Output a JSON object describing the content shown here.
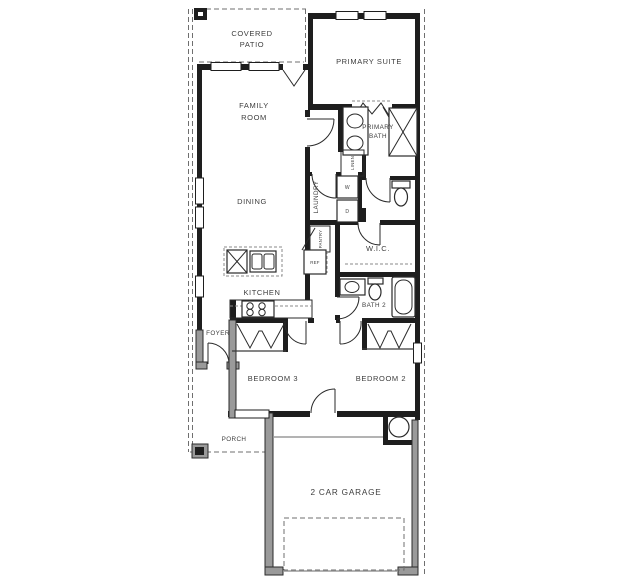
{
  "meta": {
    "type": "residential floor plan"
  },
  "colors": {
    "background": "#ffffff",
    "walls": "#1e1e1e",
    "secondary_walls": "#9a9a9a",
    "dashed_lines": "#6f6f6f",
    "label_text": "#3d3d3d"
  },
  "rooms": {
    "covered_patio": {
      "line1": "COVERED",
      "line2": "PATIO"
    },
    "primary_suite": {
      "label": "PRIMARY SUITE"
    },
    "family_room": {
      "line1": "FAMILY",
      "line2": "ROOM"
    },
    "primary_bath": {
      "line1": "PRIMARY",
      "line2": "BATH"
    },
    "dining": {
      "label": "DINING"
    },
    "laundry": {
      "label": "LAUNDRY"
    },
    "wic": {
      "label": "W.I.C."
    },
    "kitchen": {
      "label": "KITCHEN"
    },
    "bath2": {
      "label": "BATH 2"
    },
    "foyer": {
      "label": "FOYER"
    },
    "bedroom3": {
      "label": "BEDROOM 3"
    },
    "bedroom2": {
      "label": "BEDROOM 2"
    },
    "porch": {
      "label": "PORCH"
    },
    "garage": {
      "label": "2 CAR GARAGE"
    }
  },
  "fixtures": {
    "washer": "W",
    "dryer": "D",
    "refrigerator": "REF",
    "linen": "LINEN",
    "pantry": "PANTRY"
  }
}
